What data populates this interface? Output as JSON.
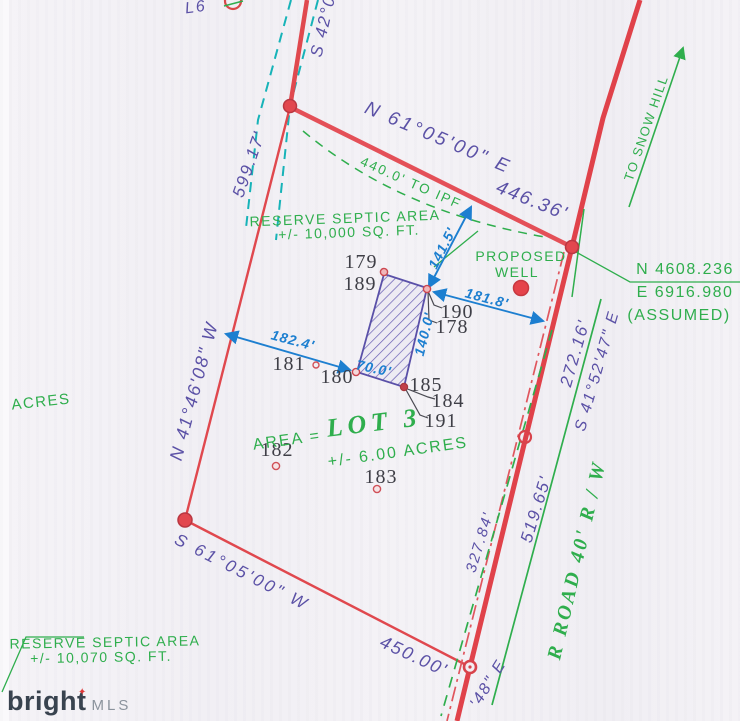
{
  "plat": {
    "l6": "L6",
    "lot_title": "LOT 3",
    "area_prefix": "AREA =",
    "area_value": "+/- 6.00 ACRES",
    "acres_fragment": "ACRES",
    "bearings": {
      "top_fragment": "S 42°0",
      "northeast": "N 61°05'00\" E",
      "west": "N 41°46'08\" W",
      "road": "S 41°52'47\" E",
      "southwest": "S 61°05'00\" W",
      "bottom_fragment": "'48\" E"
    },
    "distances": {
      "d599": "599.17'",
      "d446": "446.36'",
      "to_ipf": "440.0' TO IPF",
      "d272": "272.16'",
      "d519": "519.65'",
      "d327": "327.84'",
      "d450": "450.00'"
    },
    "dimensions": {
      "d141": "141.5'",
      "d181": "181.8'",
      "d182": "182.4'",
      "d140": "140.0'",
      "d70": "70.0'"
    },
    "notes": {
      "septic_upper_1": "RESERVE SEPTIC AREA",
      "septic_upper_2": "+/- 10,000 SQ. FT.",
      "septic_lower_1": "RESERVE SEPTIC AREA",
      "septic_lower_2": "+/- 10,070 SQ. FT.",
      "proposed_well_1": "PROPOSED",
      "proposed_well_2": "WELL",
      "to_snow_hill": "TO SNOW HILL",
      "coord_n": "N 4608.236",
      "coord_e": "E 6916.980",
      "coord_assumed": "(ASSUMED)",
      "road_name": "R ROAD 40' R / W"
    },
    "points": {
      "p179": "179",
      "p189": "189",
      "p190": "190",
      "p178": "178",
      "p181": "181",
      "p180": "180",
      "p185": "185",
      "p184": "184",
      "p191": "191",
      "p182": "182",
      "p183": "183"
    },
    "watermark": {
      "brand": "bright",
      "suffix": "MLS"
    }
  },
  "colors": {
    "boundary_red": "#e0484e",
    "survey_green": "#2fae4d",
    "dimension_blue": "#1d7fd0",
    "bearing_purple": "#5b51a6",
    "teal_dash": "#17b3b8",
    "hatch_purple": "#675cb2",
    "point_gray": "#3f3f47",
    "paper": "#f3f1f5",
    "watermark_dark": "#39434f",
    "watermark_red": "#e03a3a"
  }
}
